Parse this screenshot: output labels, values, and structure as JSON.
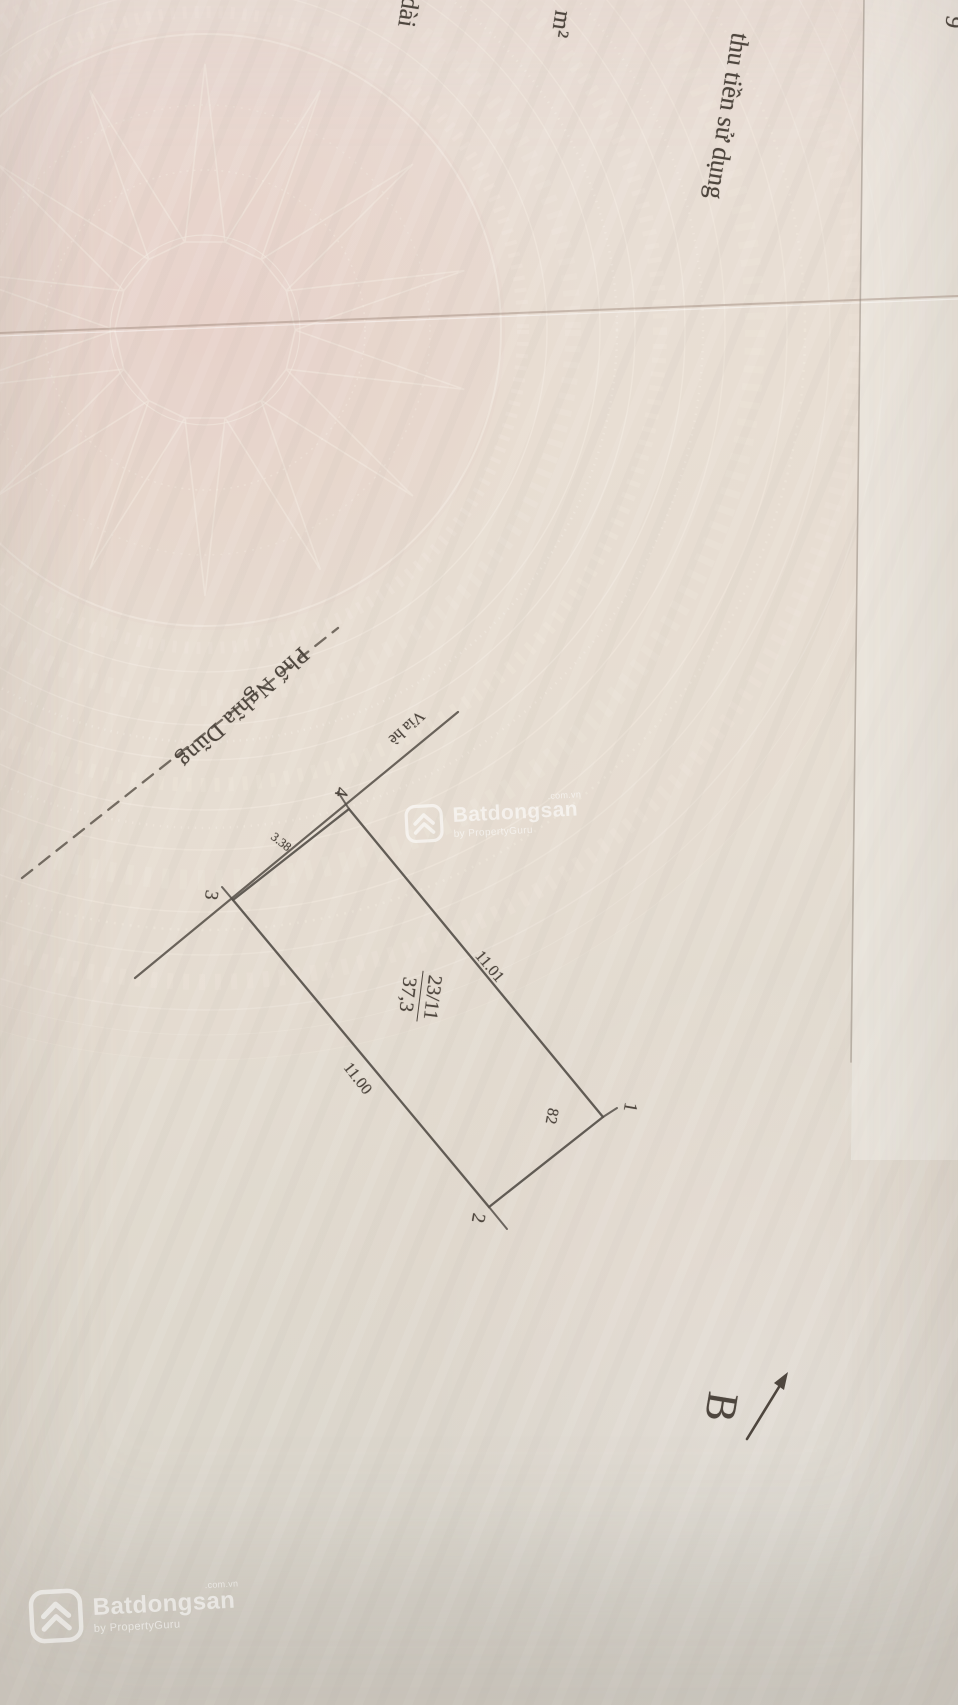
{
  "meta": {
    "description": "Photographed page of a Vietnamese land-use certificate with cadastral sketch, rotated 90°"
  },
  "fragments": {
    "fee_text": "thu tiền sử dụng",
    "area_unit": "m²",
    "left_partial": "dài",
    "right_edge_partial": "9"
  },
  "diagram": {
    "street_name": "Phố Nghĩa Dũng",
    "sidewalk_label": "Vỉa hè",
    "parcel_number": "23/11",
    "parcel_area": "37,3",
    "dim_top": "11.01",
    "dim_bottom": "11.00",
    "dim_front": "3.38",
    "adjacent_parcel": "82",
    "corners": {
      "c1": "1",
      "c2": "2",
      "c3": "3",
      "c4": "4"
    },
    "north_label": "B"
  },
  "watermark": {
    "brand": "Batdongsan",
    "domain": ".com.vn",
    "byline": "by PropertyGuru"
  },
  "colors": {
    "paper": "#e8dfd5",
    "ink": "#4e463e",
    "emblem_pattern": "#f3ebe1",
    "pink_tint": "#e7c7c0",
    "watermark": "#ffffff"
  }
}
